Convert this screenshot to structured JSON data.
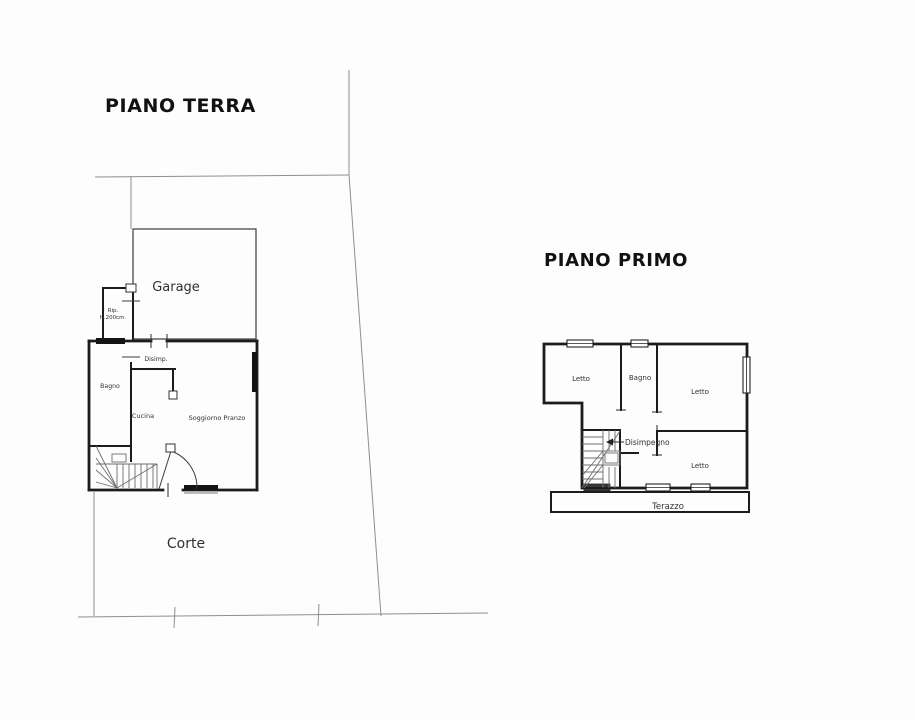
{
  "document": {
    "type": "floor-plan-drawing",
    "background": "#fdfdfd"
  },
  "ground_floor": {
    "title": "PIANO TERRA",
    "labels": {
      "garage": "Garage",
      "rip_line1": "Rip.",
      "rip_line2": "H.200cm.",
      "disimp": "Disimp.",
      "bagno": "Bagno",
      "cucina": "Cucina",
      "soggiorno": "Soggiorno Pranzo",
      "corte": "Corte"
    }
  },
  "first_floor": {
    "title": "PIANO PRIMO",
    "labels": {
      "letto_nw": "Letto",
      "bagno": "Bagno",
      "letto_ne": "Letto",
      "disimpegno": "Disimpegno",
      "letto_se": "Letto",
      "terazzo": "Terazzo"
    }
  },
  "colors": {
    "wall": "#1c1c1c",
    "boundary_line": "#8f8f8f",
    "window_glass": "#141414",
    "text": "#303030"
  }
}
